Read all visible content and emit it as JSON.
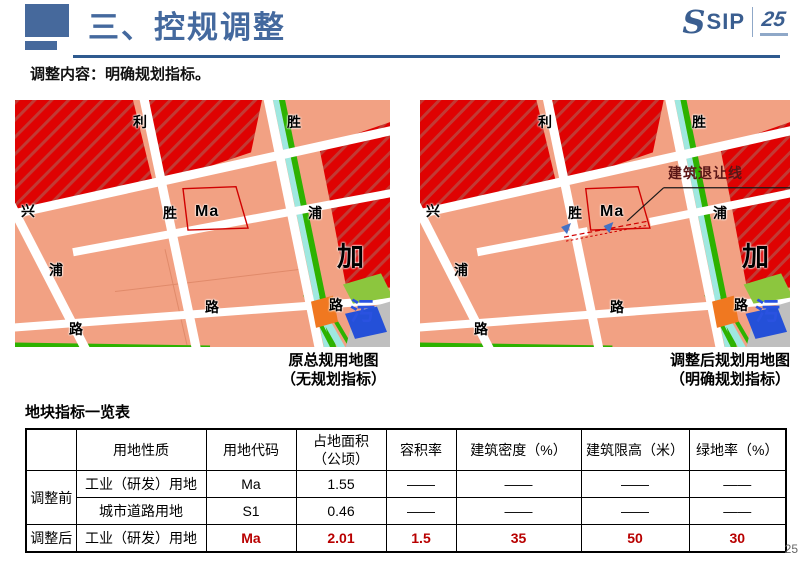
{
  "header": {
    "title": "三、控规调整"
  },
  "logo": {
    "glyph": "S",
    "text": "SIP",
    "anniversary": "25"
  },
  "subtitle": "调整内容：明确规划指标。",
  "maps": {
    "left": {
      "caption_line1": "原总规用地图",
      "caption_line2": "（无规划指标）",
      "labels": [
        {
          "t": "利",
          "x": 118,
          "y": 15
        },
        {
          "t": "胜",
          "x": 272,
          "y": 15
        },
        {
          "t": "兴",
          "x": 6,
          "y": 104
        },
        {
          "t": "胜",
          "x": 148,
          "y": 106
        },
        {
          "t": "Ma",
          "x": 180,
          "y": 104,
          "cls": "ma"
        },
        {
          "t": "浦",
          "x": 293,
          "y": 106
        },
        {
          "t": "浦",
          "x": 34,
          "y": 163
        },
        {
          "t": "路",
          "x": 190,
          "y": 200
        },
        {
          "t": "路",
          "x": 314,
          "y": 198
        },
        {
          "t": "路",
          "x": 54,
          "y": 222
        },
        {
          "t": "加",
          "x": 322,
          "y": 144,
          "cls": "big"
        },
        {
          "t": "污",
          "x": 335,
          "y": 200,
          "cls": "wu"
        }
      ]
    },
    "right": {
      "caption_line1": "调整后规划用地图",
      "caption_line2": "（明确规划指标）",
      "labels": [
        {
          "t": "利",
          "x": 118,
          "y": 15
        },
        {
          "t": "胜",
          "x": 272,
          "y": 15
        },
        {
          "t": "兴",
          "x": 6,
          "y": 104
        },
        {
          "t": "胜",
          "x": 148,
          "y": 106
        },
        {
          "t": "Ma",
          "x": 180,
          "y": 104,
          "cls": "ma"
        },
        {
          "t": "浦",
          "x": 293,
          "y": 106
        },
        {
          "t": "浦",
          "x": 34,
          "y": 163
        },
        {
          "t": "路",
          "x": 190,
          "y": 200
        },
        {
          "t": "路",
          "x": 314,
          "y": 198
        },
        {
          "t": "路",
          "x": 54,
          "y": 222
        },
        {
          "t": "加",
          "x": 322,
          "y": 144,
          "cls": "big"
        },
        {
          "t": "污",
          "x": 335,
          "y": 200,
          "cls": "wu"
        },
        {
          "t": "建筑退让线",
          "x": 248,
          "y": 66,
          "cls": "setback"
        }
      ]
    }
  },
  "table": {
    "title": "地块指标一览表",
    "headers": [
      "",
      "用地性质",
      "用地代码",
      "占地面积\n（公顷）",
      "容积率",
      "建筑密度（%）",
      "建筑限高（米）",
      "绿地率（%）"
    ],
    "col_widths": [
      50,
      130,
      90,
      90,
      70,
      125,
      108,
      97
    ],
    "rows": [
      {
        "group": "调整前",
        "group_span": 2,
        "highlight": false,
        "cells": [
          "工业（研发）用地",
          "Ma",
          "1.55",
          "——",
          "——",
          "——",
          "——"
        ]
      },
      {
        "highlight": false,
        "cells": [
          "城市道路用地",
          "S1",
          "0.46",
          "——",
          "——",
          "——",
          "——"
        ]
      },
      {
        "group": "调整后",
        "group_span": 1,
        "highlight": true,
        "cells": [
          "工业（研发）用地",
          "Ma",
          "2.01",
          "1.5",
          "35",
          "50",
          "30"
        ]
      }
    ]
  },
  "page_number": "25",
  "colors": {
    "accent_blue": "#44699E",
    "map_salmon": "#F2A183",
    "map_red": "#DF0202",
    "parcel_red": "#D00000",
    "table_red": "#B80000"
  }
}
